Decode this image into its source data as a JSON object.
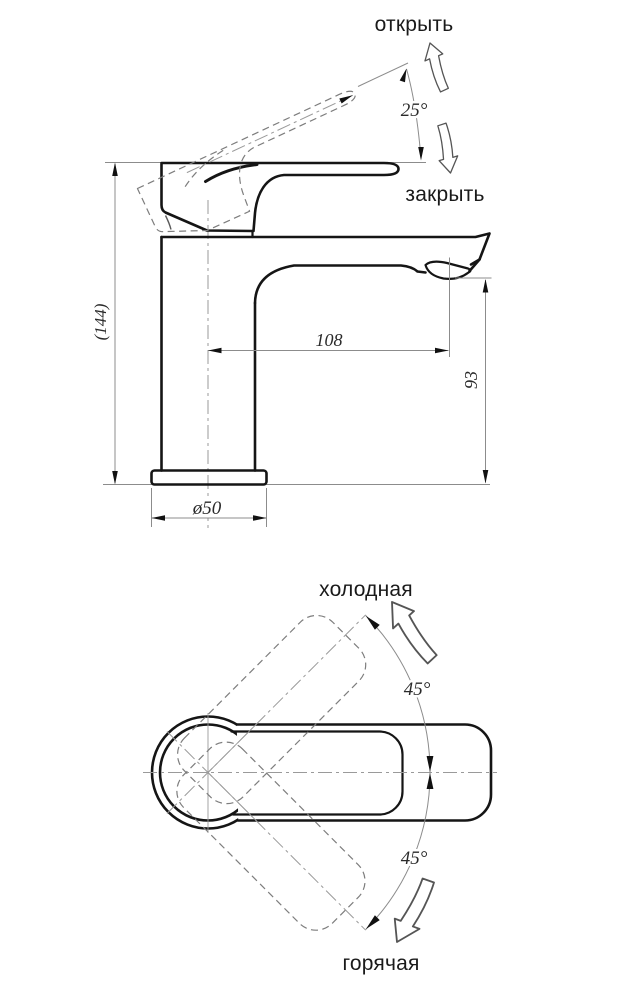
{
  "side_view": {
    "open_label": "открыть",
    "close_label": "закрыть",
    "dims": {
      "lever_angle": "25°",
      "height": "(144)",
      "spout_reach": "108",
      "spout_height": "93",
      "base_diameter": "ø50"
    }
  },
  "plan_view": {
    "cold_label": "холодная",
    "hot_label": "горячая",
    "dims": {
      "cold_angle": "45°",
      "hot_angle": "45°"
    }
  },
  "colors": {
    "outline": "#151515",
    "dimension_line": "#8c8c8c",
    "text": "#1a1a1a"
  }
}
